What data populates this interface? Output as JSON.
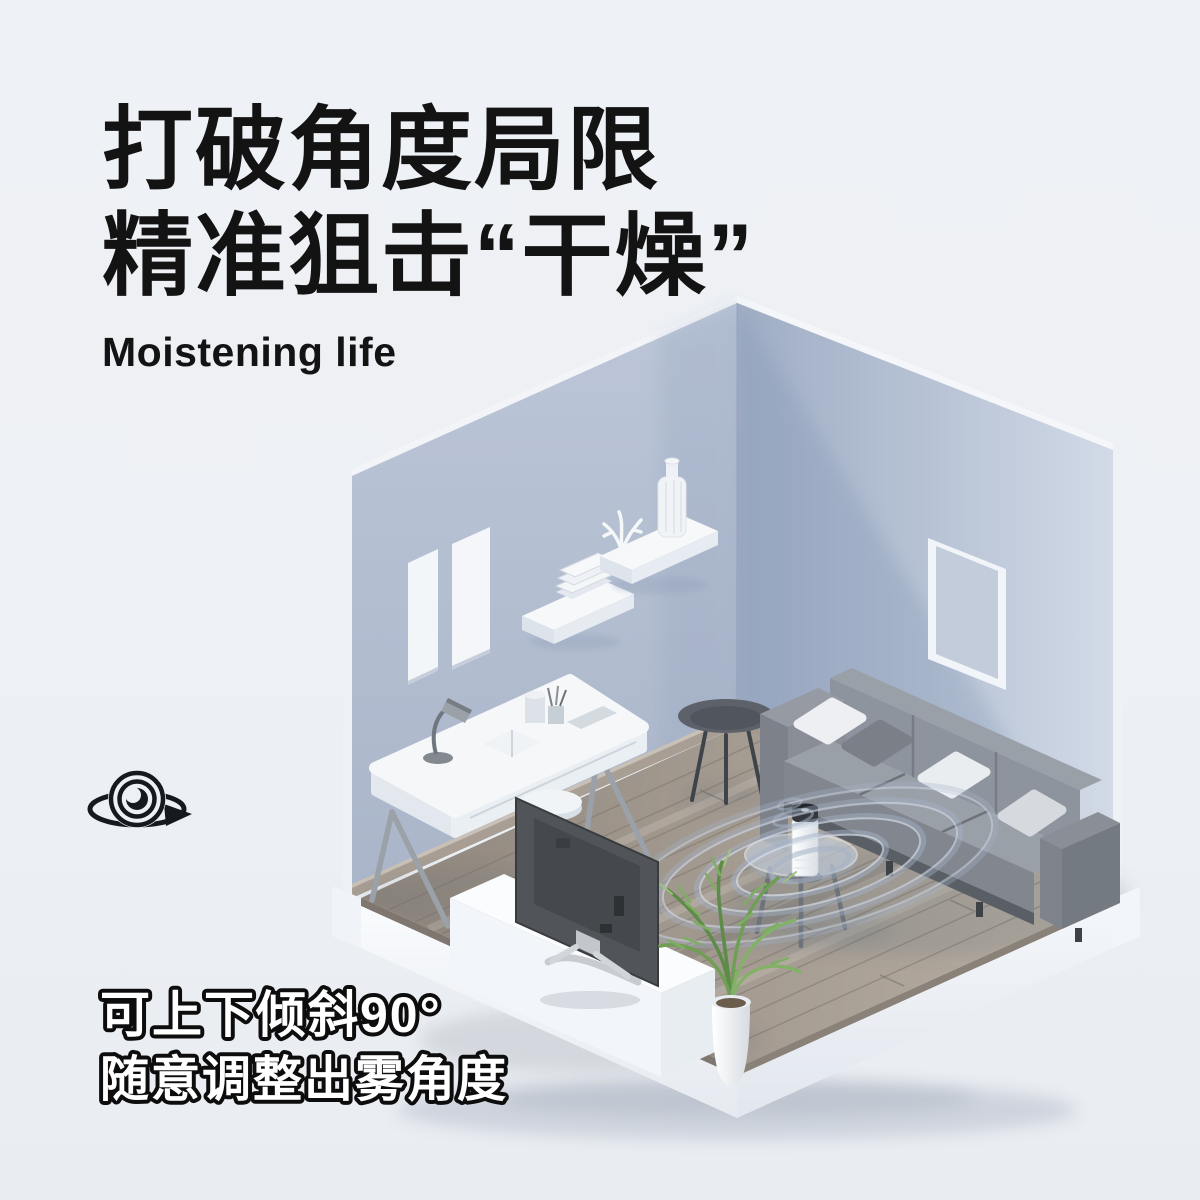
{
  "poster": {
    "background": "#edf0f4",
    "title": {
      "line1": "打破角度局限",
      "line2": "精准狙击“干燥”",
      "color": "#131313"
    },
    "subtitle": {
      "text": "Moistening life",
      "color": "#131313"
    },
    "caption": {
      "line1": "可上下倾斜90°",
      "line2": "随意调整出雾角度",
      "fill": "#ffffff",
      "outline": "#0d0d0d"
    },
    "icons": [
      {
        "name": "rotate-360-icon",
        "color": "#16191d"
      }
    ],
    "scene": {
      "objects": [
        "left-wall",
        "right-wall",
        "wood-floor",
        "white-platform",
        "picture-frames",
        "wall-shelf-books",
        "corner-shelf-decor",
        "desk",
        "desk-lamp",
        "stool",
        "side-table",
        "sofa",
        "coffee-table",
        "humidifier",
        "mist-rings",
        "media-console",
        "tv",
        "potted-plant"
      ],
      "colors": {
        "wall_left": "#b3bed1",
        "wall_right_light": "#d2dae7",
        "wall_right_dark": "#9fadc4",
        "floor_wood_dark": "#8f867d",
        "floor_wood_light": "#b8afa4",
        "platform_white": "#f6f8fb",
        "sofa_gray": "#8e949d",
        "pillow_white": "#edeff2",
        "mist_ring": "#a4b2c7",
        "plant_green": "#6f9e55",
        "humidifier_body": "#f7f9fa",
        "humidifier_cap": "#34383d"
      }
    }
  }
}
